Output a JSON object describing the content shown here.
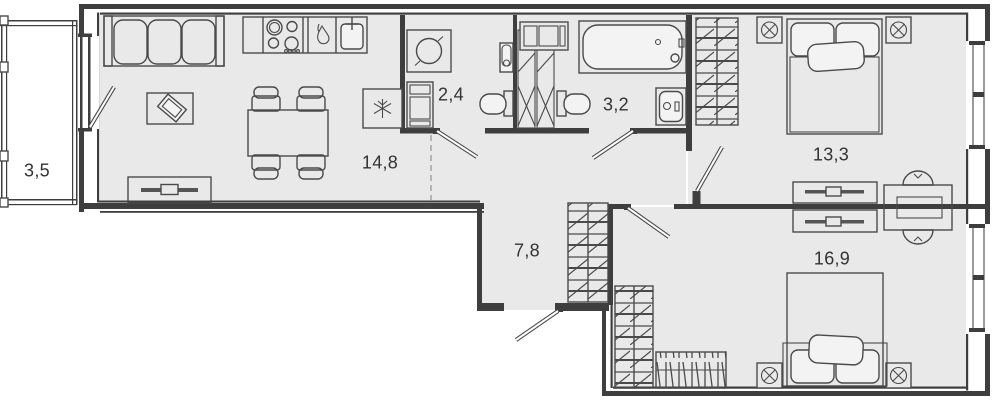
{
  "plan": {
    "type": "apartment-floor-plan",
    "rooms": [
      {
        "id": "balcony",
        "area_label": "3,5"
      },
      {
        "id": "kitchen-living-room",
        "area_label": "14,8"
      },
      {
        "id": "laundry-wc",
        "area_label": "2,4"
      },
      {
        "id": "bathroom",
        "area_label": "3,2"
      },
      {
        "id": "hallway",
        "area_label": "7,8"
      },
      {
        "id": "bedroom-1",
        "area_label": "13,3"
      },
      {
        "id": "bedroom-2",
        "area_label": "16,9"
      }
    ],
    "colors": {
      "background": "#ffffff",
      "floor": "#e9e9e9",
      "walls": "#3e3e3e",
      "furniture_line": "#4a4a4a"
    }
  }
}
